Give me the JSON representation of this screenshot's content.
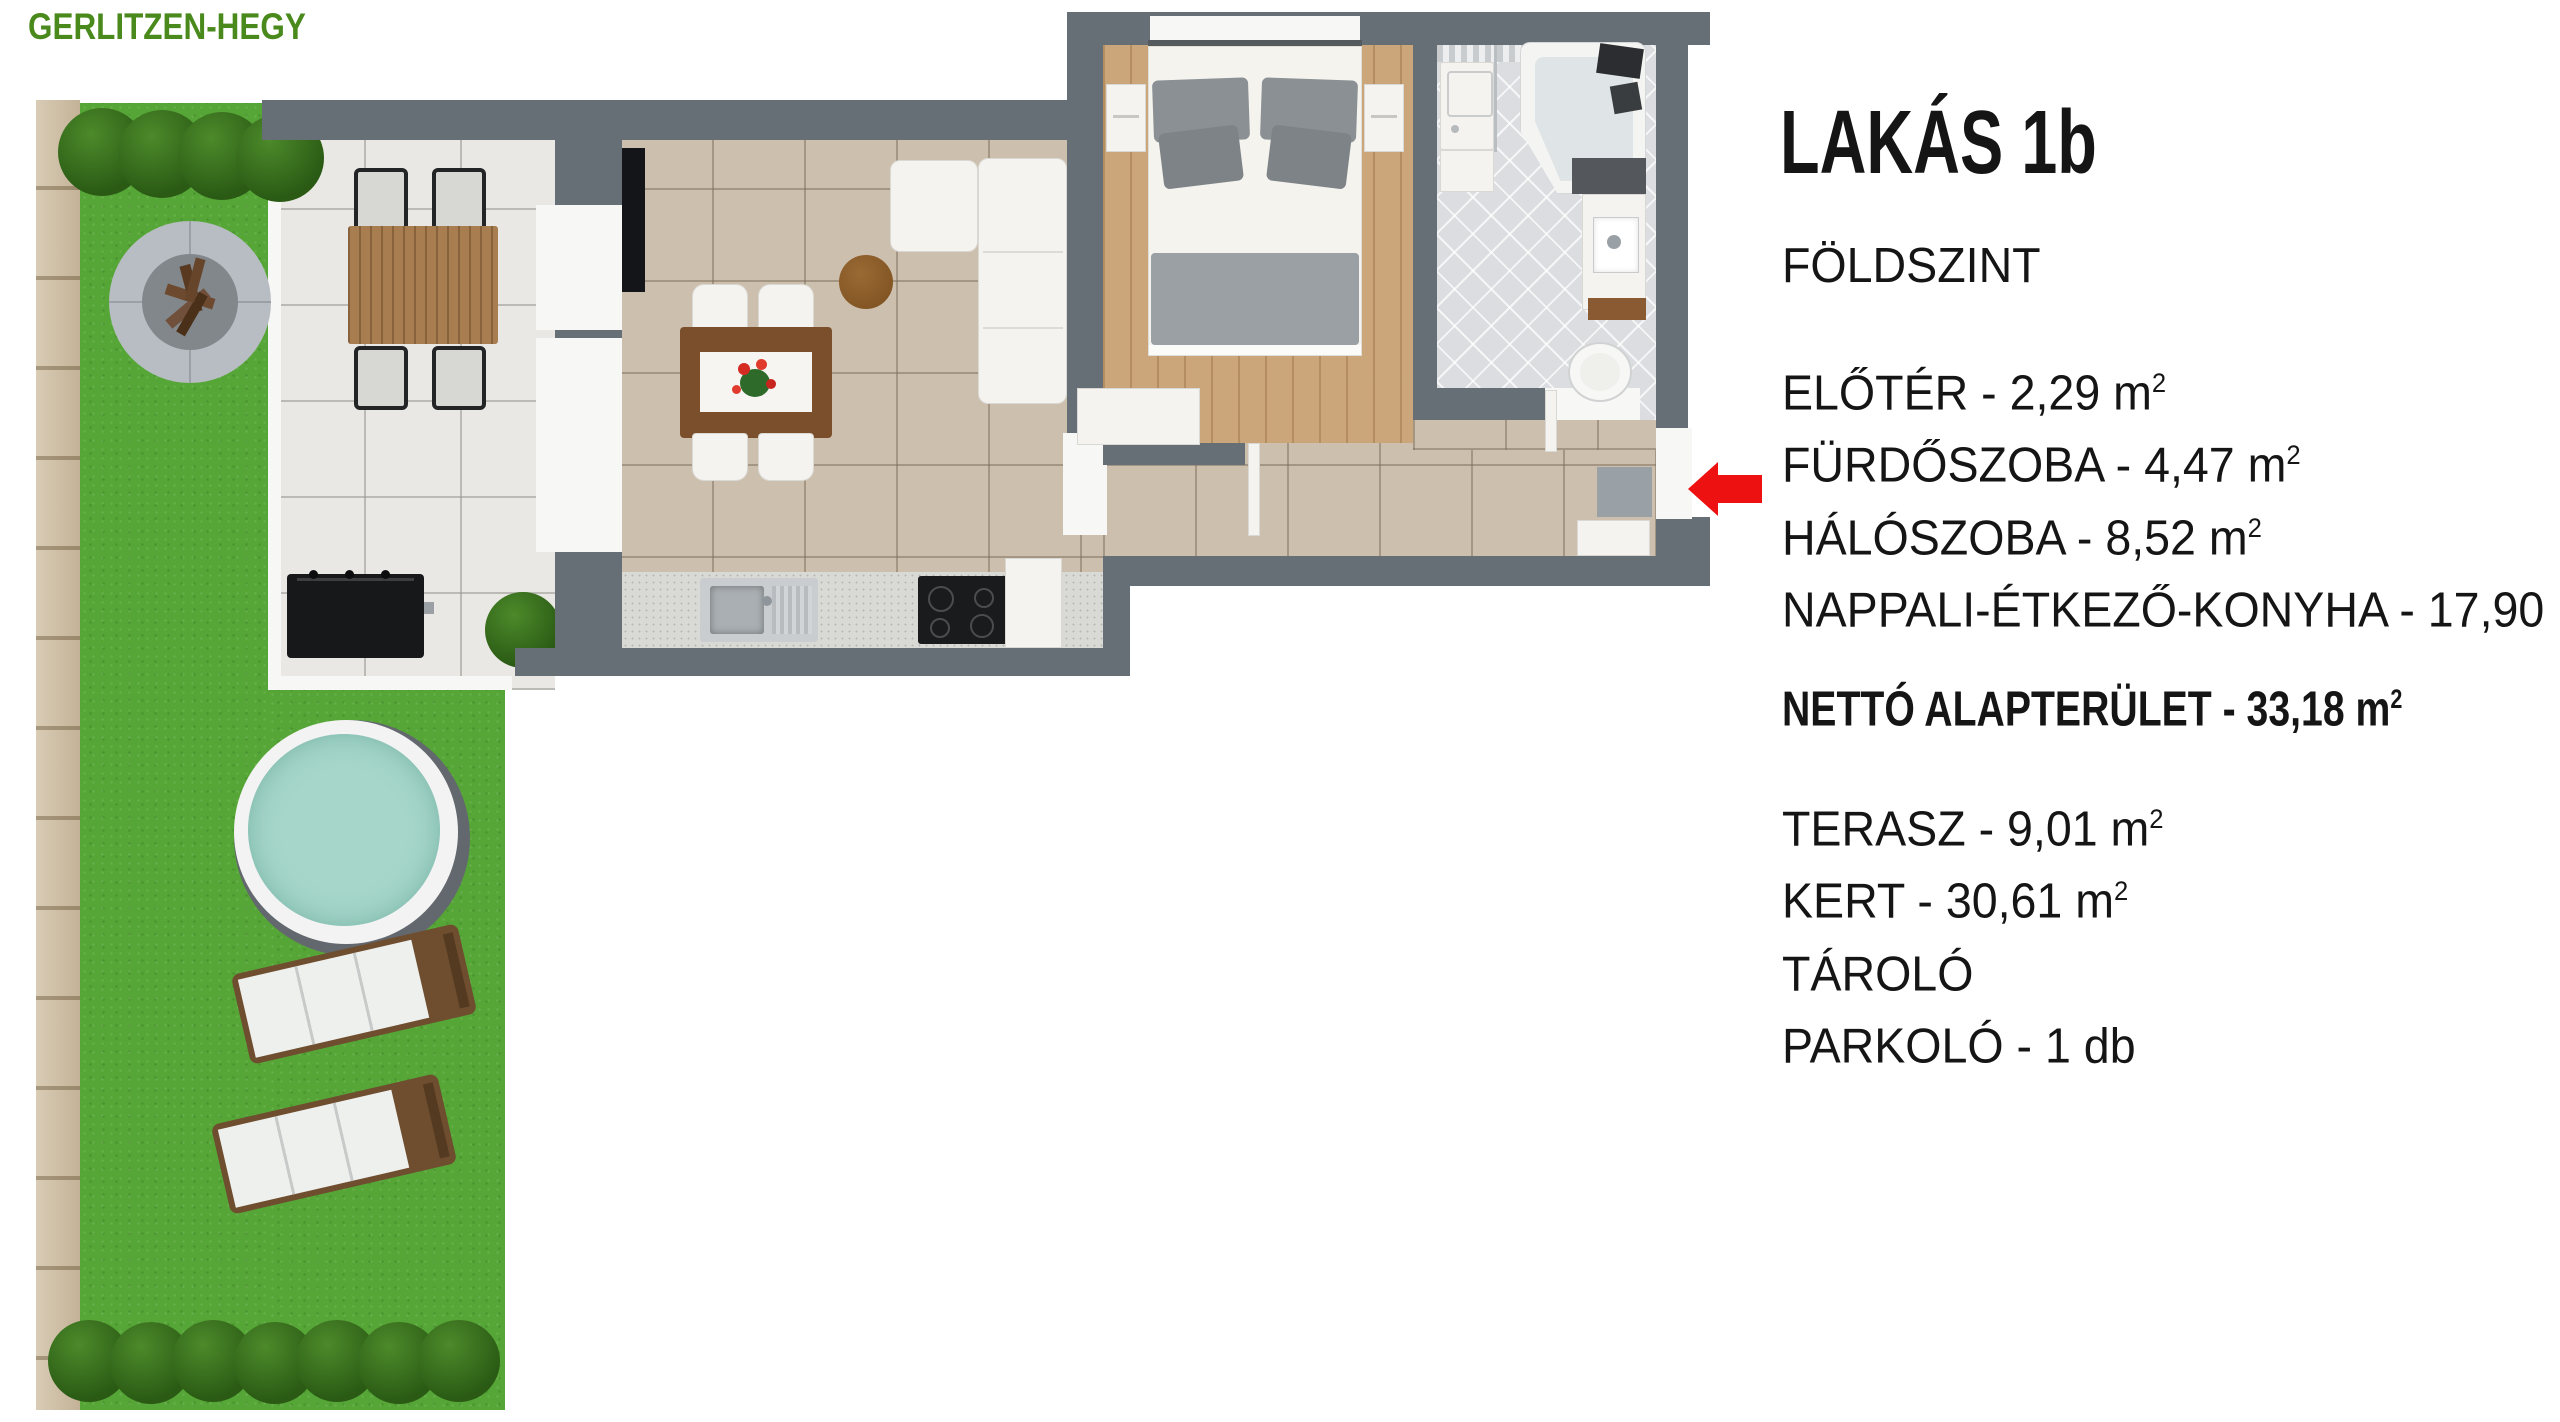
{
  "brand": {
    "name": "GERLITZEN-HEGY"
  },
  "panel": {
    "title": "LAKÁS 1b",
    "floor_label": "FÖLDSZINT",
    "rooms": [
      {
        "label": "ELŐTÉR - 2,29 m",
        "sup": "2"
      },
      {
        "label": "FÜRDŐSZOBA - 4,47 m",
        "sup": "2"
      },
      {
        "label": "HÁLÓSZOBA - 8,52 m",
        "sup": "2"
      },
      {
        "label": "NAPPALI-ÉTKEZŐ-KONYHA - 17,90 m",
        "sup": "2"
      }
    ],
    "total": {
      "label": "NETTÓ ALAPTERÜLET - 33,18 m",
      "sup": "2"
    },
    "extras": [
      {
        "label": "TERASZ - 9,01 m",
        "sup": "2"
      },
      {
        "label": "KERT - 30,61 m",
        "sup": "2"
      },
      {
        "label": "TÁROLÓ",
        "sup": ""
      },
      {
        "label": "PARKOLÓ - 1 db",
        "sup": ""
      }
    ]
  },
  "colors": {
    "brand_green": "#4a8a1c",
    "wall_gray": "#666e76",
    "grass_green": "#56a637",
    "pool_water": "#a5d6c9",
    "entrance_arrow_red": "#ee1111"
  }
}
